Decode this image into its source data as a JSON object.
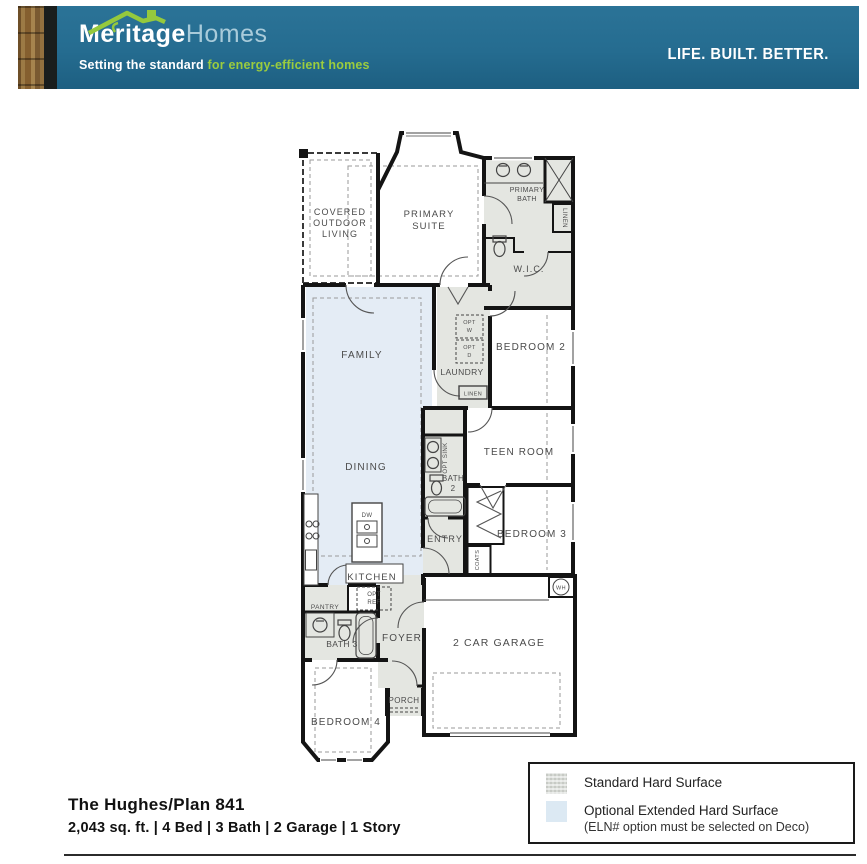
{
  "header": {
    "brand_primary": "Meritage",
    "brand_secondary": "Homes",
    "tagline_bold": "Setting the standard",
    "tagline_green": "for energy-efficient homes",
    "slogan": "LIFE. BUILT. BETTER.",
    "banner_color": "#266d90",
    "brand_green": "#95c93d"
  },
  "plan": {
    "labels": {
      "col_line1": "COVERED",
      "col_line2": "OUTDOOR",
      "col_line3": "LIVING",
      "primary_suite_line1": "PRIMARY",
      "primary_suite_line2": "SUITE",
      "primary_bath_line1": "PRIMARY",
      "primary_bath_line2": "BATH",
      "wic": "W.I.C.",
      "linen_primary": "LINEN",
      "family": "FAMILY",
      "laundry": "LAUNDRY",
      "opt_washer_line1": "OPT",
      "opt_washer_line2": "W",
      "opt_dryer_line1": "OPT",
      "opt_dryer_line2": "D",
      "linen_hall": "LINEN",
      "bedroom2": "BEDROOM 2",
      "teen_room": "TEEN ROOM",
      "dining": "DINING",
      "opt_sink": "OPT SINK",
      "bath2_line1": "BATH",
      "bath2_line2": "2",
      "entry": "ENTRY",
      "bedroom3": "BEDROOM 3",
      "coats": "COATS",
      "kitchen": "KITCHEN",
      "dishwasher": "DW",
      "pantry": "PANTRY",
      "opt_ref_line1": "OPT",
      "opt_ref_line2": "REF",
      "bath3": "BATH 3",
      "foyer": "FOYER",
      "garage": "2 CAR GARAGE",
      "porch": "PORCH",
      "bedroom4": "BEDROOM 4",
      "water_heater": "WH"
    }
  },
  "legend": {
    "standard_label": "Standard Hard Surface",
    "optional_label": "Optional Extended Hard Surface",
    "optional_note": "(ELN# option must be selected on Deco)",
    "standard_color": "#d8dbd6",
    "optional_color": "#dce9f3"
  },
  "footer": {
    "plan_title": "The Hughes/Plan 841",
    "specs": "2,043 sq. ft. | 4 Bed | 3 Bath | 2 Garage | 1 Story"
  }
}
